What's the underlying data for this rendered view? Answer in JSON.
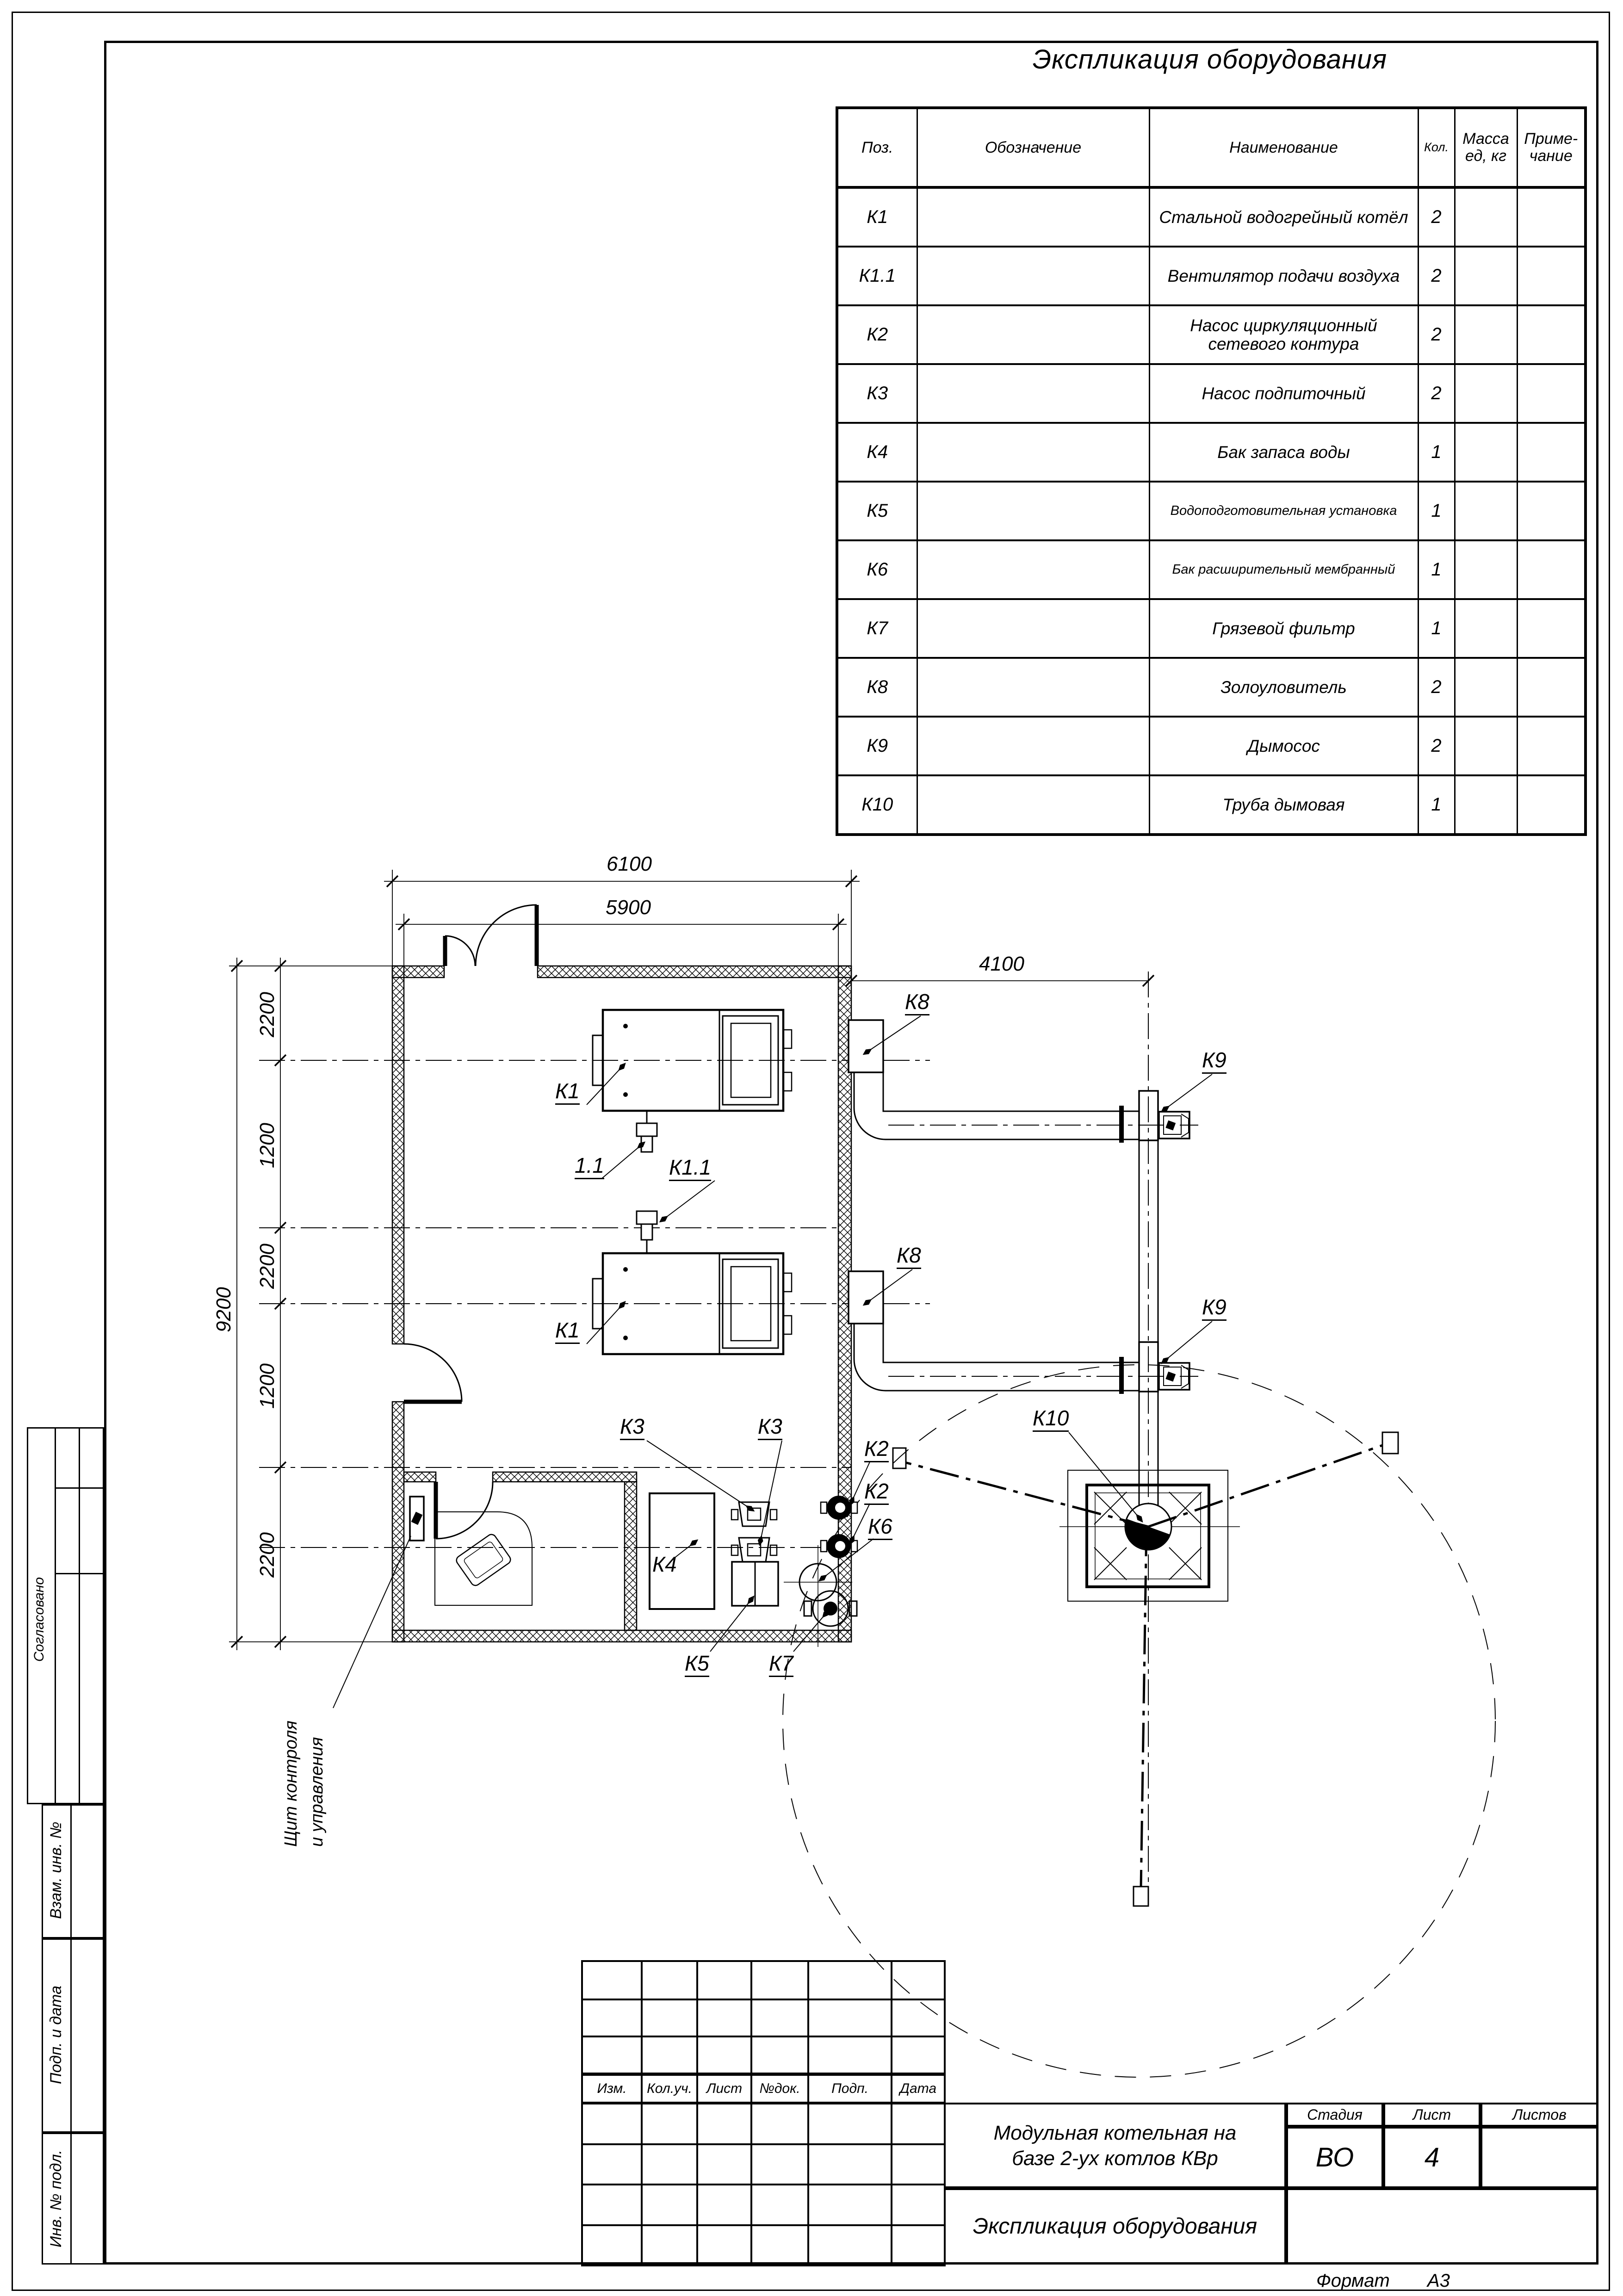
{
  "sheet": {
    "table_title": "Экспликация оборудования",
    "equipment_table": {
      "headers": {
        "pos": "Поз.",
        "designation": "Обозначение",
        "name": "Наименование",
        "qty": "Кол.",
        "mass": "Масса\nед, кг",
        "note": "Приме-\nчание"
      },
      "rows": [
        {
          "pos": "К1",
          "name": "Стальной водогрейный котёл",
          "qty": "2"
        },
        {
          "pos": "К1.1",
          "name": "Вентилятор подачи воздуха",
          "qty": "2"
        },
        {
          "pos": "К2",
          "name": "Насос циркуляционный сетевого контура",
          "qty": "2"
        },
        {
          "pos": "К3",
          "name": "Насос подпиточный",
          "qty": "2"
        },
        {
          "pos": "К4",
          "name": "Бак запаса воды",
          "qty": "1"
        },
        {
          "pos": "К5",
          "name": "Водоподготовительная установка",
          "qty": "1"
        },
        {
          "pos": "К6",
          "name": "Бак расширительный мембранный",
          "qty": "1"
        },
        {
          "pos": "К7",
          "name": "Грязевой фильтр",
          "qty": "1"
        },
        {
          "pos": "К8",
          "name": "Золоуловитель",
          "qty": "2"
        },
        {
          "pos": "К9",
          "name": "Дымосос",
          "qty": "2"
        },
        {
          "pos": "К10",
          "name": "Труба дымовая",
          "qty": "1"
        }
      ]
    },
    "plan": {
      "dims": {
        "d6100": "6100",
        "d5900": "5900",
        "d4100": "4100",
        "d9200": "9200",
        "c1": "2200",
        "c2": "1200",
        "c3": "2200",
        "c4": "1200",
        "c5": "2200"
      },
      "labels": {
        "k1a": "К1",
        "k11a": "1.1",
        "k11b": "К1.1",
        "k1b": "К1",
        "k8a": "К8",
        "k8b": "К8",
        "k9a": "К9",
        "k9b": "К9",
        "k10": "К10",
        "k3a": "К3",
        "k3b": "К3",
        "k2a": "К2",
        "k2b": "К2",
        "k6": "К6",
        "k4": "К4",
        "k5": "К5",
        "k7": "К7",
        "panel_line1": "Щит контроля",
        "panel_line2": "и управления"
      }
    },
    "title_block": {
      "revision_headers": [
        "Изм.",
        "Кол.уч.",
        "Лист",
        "№док.",
        "Подп.",
        "Дата"
      ],
      "project_title_line1": "Модульная котельная на",
      "project_title_line2": "базе 2-ух котлов КВр",
      "sheet_title": "Экспликация оборудования",
      "stage_label": "Стадия",
      "sheet_label": "Лист",
      "sheets_label": "Листов",
      "stage_value": "ВО",
      "sheet_value": "4",
      "sheets_value": "",
      "format_label": "Формат",
      "format_value": "А3"
    },
    "side_labels": {
      "agreed": "Согласовано",
      "vzam": "Взам. инв. №",
      "podp": "Подп. и дата",
      "inv": "Инв. № подл."
    }
  }
}
